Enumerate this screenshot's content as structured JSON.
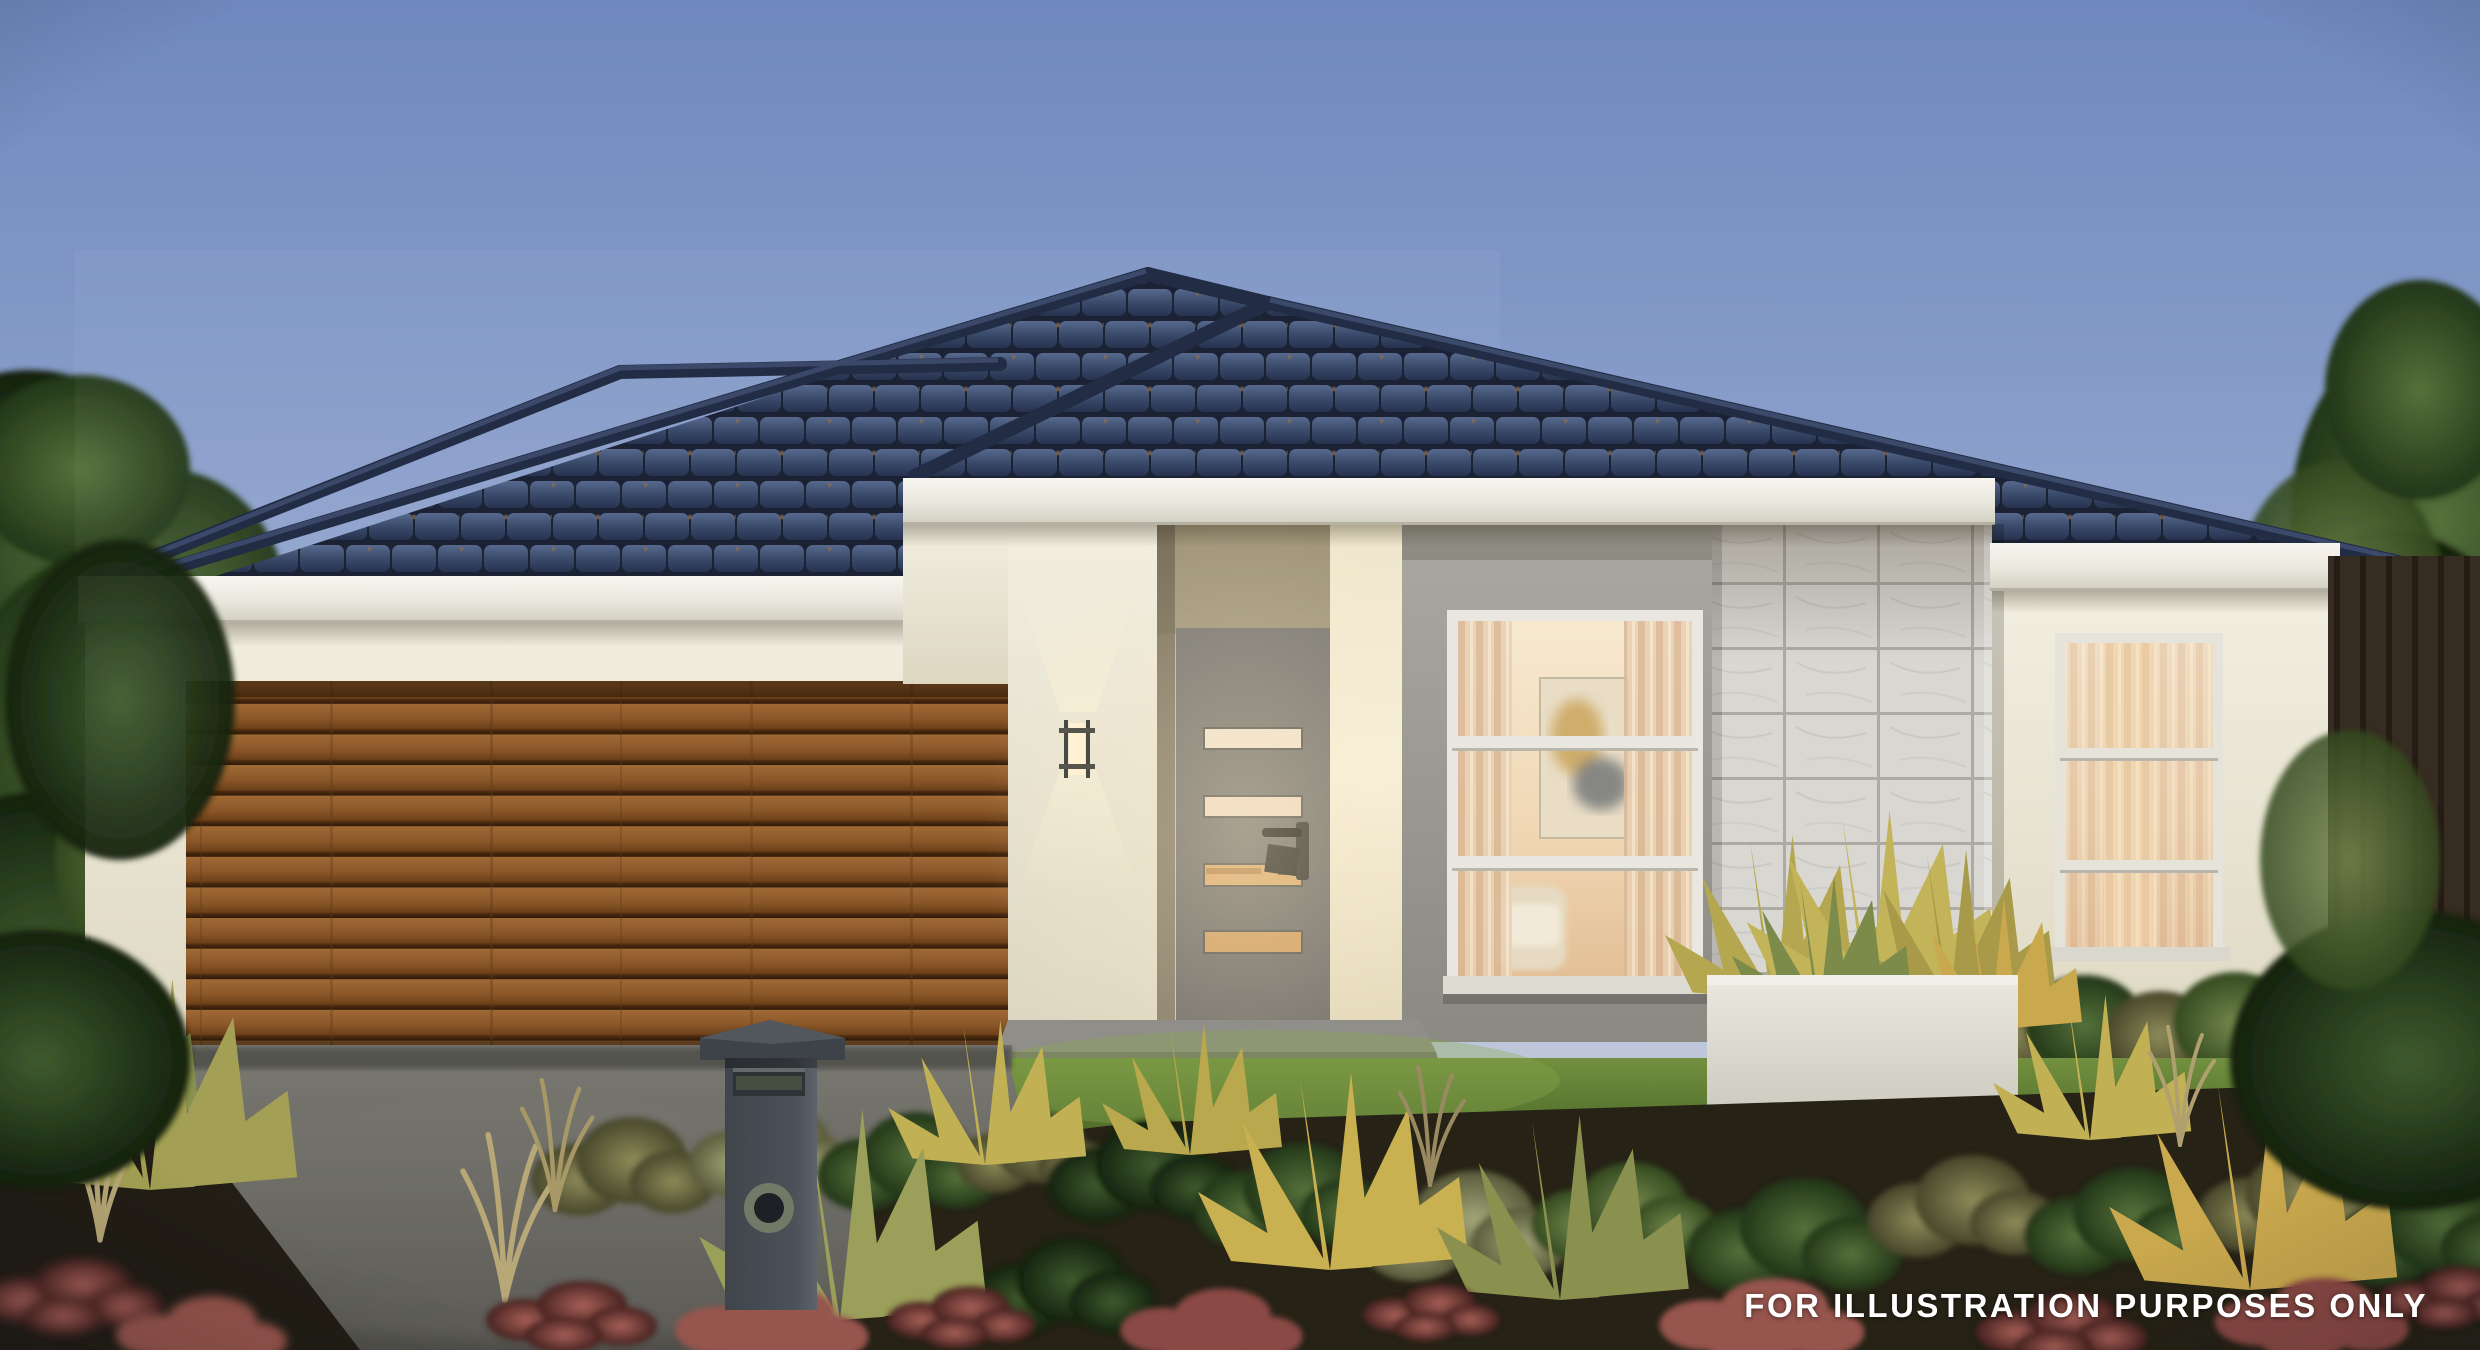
{
  "disclaimer": "FOR ILLUSTRATION PURPOSES ONLY",
  "scene": {
    "subject": "single-storey house facade at dusk",
    "elements": [
      "sky",
      "hip-tile-roof",
      "fascia-gutter",
      "garage-timber-door",
      "entry-door-with-glass-slats",
      "porch-wall-light",
      "feature-window-with-artwork",
      "stone-feature-pier",
      "planter-box-with-grasses",
      "right-window",
      "hedge",
      "lawn",
      "driveway",
      "mailbox",
      "garden-beds",
      "side-trees",
      "timber-fence"
    ]
  },
  "colors": {
    "sky_top": "#6f88bd",
    "sky_horizon": "#ddd5d1",
    "roof_tile": "#3c4c6c",
    "ridge_cap": "#222c44",
    "fascia": "#efede3",
    "wall_render": "#ece7d5",
    "garage_door_timber": "#8a5a2a",
    "front_door": "#73726d",
    "door_glass_warm": "#d9a96c",
    "bay_wall_grey": "#9a998f",
    "stone_feature": "#d9d7d2",
    "planter": "#dfdcd3",
    "lawn": "#5d7a36",
    "driveway": "#6b6a64",
    "fence": "#35291f",
    "mailbox": "#4b5158",
    "foliage_green": "#3f5a2e",
    "foliage_olive": "#8d8a58",
    "foliage_burgundy": "#96544e",
    "grass_yellow": "#c2b055",
    "disclaimer_text": "#ffffff"
  }
}
